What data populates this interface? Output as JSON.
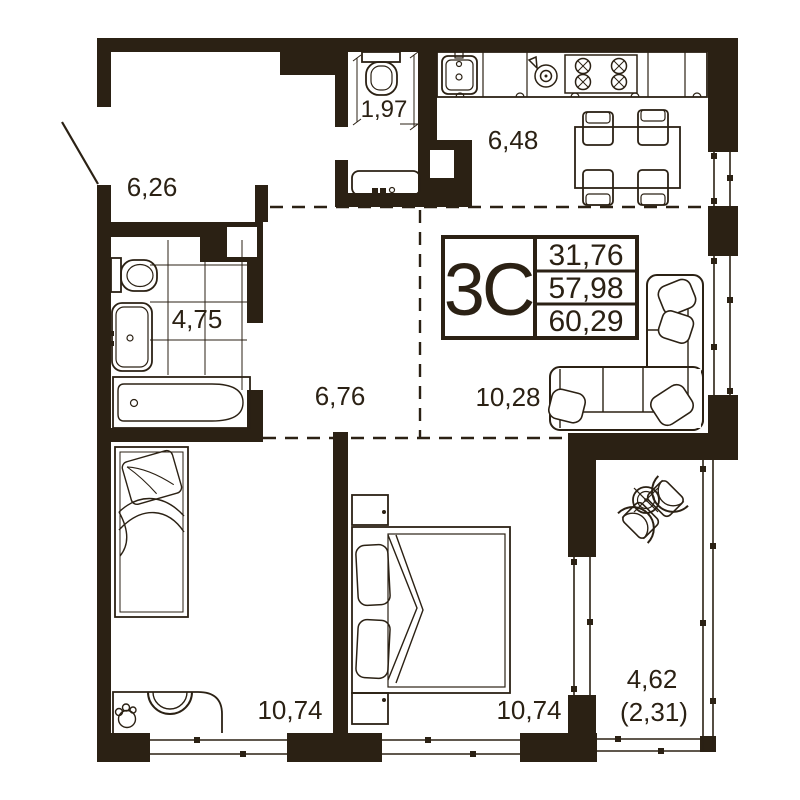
{
  "plan": {
    "unit": {
      "type_label": "3C",
      "values": [
        "31,76",
        "57,98",
        "60,29"
      ]
    },
    "rooms": {
      "hall": "6,26",
      "wc": "1,97",
      "kitchen": "6,48",
      "bathroom": "4,75",
      "corridor": "6,76",
      "living": "10,28",
      "bedroom_left": "10,74",
      "bedroom_right": "10,74",
      "balcony": "4,62",
      "balcony_coef": "(2,31)"
    },
    "colors": {
      "ink": "#2b2114",
      "bg": "#ffffff"
    }
  }
}
